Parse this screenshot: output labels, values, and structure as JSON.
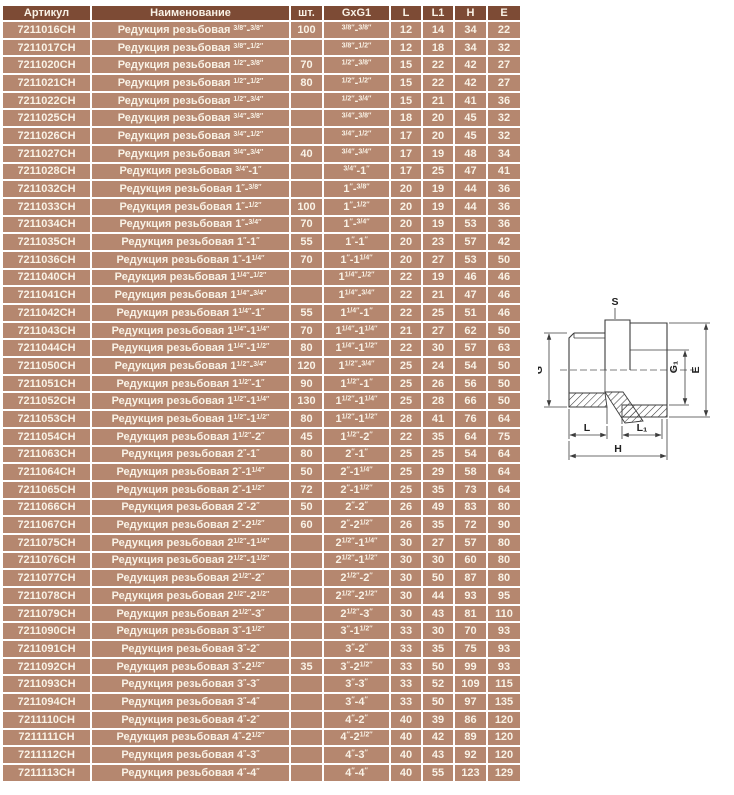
{
  "page": {
    "background": "#ffffff"
  },
  "table": {
    "columns": [
      "Артикул",
      "Наименование",
      "шт.",
      "GxG1",
      "L",
      "L1",
      "H",
      "E"
    ],
    "name_prefix": "Редукция резьбовая",
    "inch_mark": "″",
    "size_separator": "-",
    "colors": {
      "header_bg": "#7d4b35",
      "row_bg": "#b5876f",
      "text": "#f9f2e6",
      "separator": "#ffffff"
    },
    "rows": [
      {
        "art": "7211016CH",
        "qty": "100",
        "g": "3/8",
        "g1": "3/8",
        "dims": [
          "12",
          "14",
          "34",
          "22"
        ]
      },
      {
        "art": "7211017CH",
        "qty": "",
        "g": "3/8",
        "g1": "1/2",
        "dims": [
          "12",
          "18",
          "34",
          "32"
        ]
      },
      {
        "art": "7211020CH",
        "qty": "70",
        "g": "1/2",
        "g1": "3/8",
        "dims": [
          "15",
          "22",
          "42",
          "27"
        ]
      },
      {
        "art": "7211021CH",
        "qty": "80",
        "g": "1/2",
        "g1": "1/2",
        "dims": [
          "15",
          "22",
          "42",
          "27"
        ]
      },
      {
        "art": "7211022CH",
        "qty": "",
        "g": "1/2",
        "g1": "3/4",
        "dims": [
          "15",
          "21",
          "41",
          "36"
        ]
      },
      {
        "art": "7211025CH",
        "qty": "",
        "g": "3/4",
        "g1": "3/8",
        "dims": [
          "18",
          "20",
          "45",
          "32"
        ]
      },
      {
        "art": "7211026CH",
        "qty": "",
        "g": "3/4",
        "g1": "1/2",
        "dims": [
          "17",
          "20",
          "45",
          "32"
        ]
      },
      {
        "art": "7211027CH",
        "qty": "40",
        "g": "3/4",
        "g1": "3/4",
        "dims": [
          "17",
          "19",
          "48",
          "34"
        ]
      },
      {
        "art": "7211028CH",
        "qty": "",
        "g": "3/4",
        "g1": "1",
        "dims": [
          "17",
          "25",
          "47",
          "41"
        ]
      },
      {
        "art": "7211032CH",
        "qty": "",
        "g": "1",
        "g1": "3/8",
        "dims": [
          "20",
          "19",
          "44",
          "36"
        ]
      },
      {
        "art": "7211033CH",
        "qty": "100",
        "g": "1",
        "g1": "1/2",
        "dims": [
          "20",
          "19",
          "44",
          "36"
        ]
      },
      {
        "art": "7211034CH",
        "qty": "70",
        "g": "1",
        "g1": "3/4",
        "dims": [
          "20",
          "19",
          "53",
          "36"
        ]
      },
      {
        "art": "7211035CH",
        "qty": "55",
        "g": "1",
        "g1": "1",
        "dims": [
          "20",
          "23",
          "57",
          "42"
        ]
      },
      {
        "art": "7211036CH",
        "qty": "70",
        "g": "1",
        "g1": "1 1/4",
        "dims": [
          "20",
          "27",
          "53",
          "50"
        ]
      },
      {
        "art": "7211040CH",
        "qty": "",
        "g": "1 1/4",
        "g1": "1/2",
        "dims": [
          "22",
          "19",
          "46",
          "46"
        ]
      },
      {
        "art": "7211041CH",
        "qty": "",
        "g": "1 1/4",
        "g1": "3/4",
        "dims": [
          "22",
          "21",
          "47",
          "46"
        ]
      },
      {
        "art": "7211042CH",
        "qty": "55",
        "g": "1 1/4",
        "g1": "1",
        "dims": [
          "22",
          "25",
          "51",
          "46"
        ]
      },
      {
        "art": "7211043CH",
        "qty": "70",
        "g": "1 1/4",
        "g1": "1 1/4",
        "dims": [
          "21",
          "27",
          "62",
          "50"
        ]
      },
      {
        "art": "7211044CH",
        "qty": "80",
        "g": "1 1/4",
        "g1": "1 1/2",
        "dims": [
          "22",
          "30",
          "57",
          "63"
        ]
      },
      {
        "art": "7211050CH",
        "qty": "120",
        "g": "1 1/2",
        "g1": "3/4",
        "dims": [
          "25",
          "24",
          "54",
          "50"
        ]
      },
      {
        "art": "7211051CH",
        "qty": "90",
        "g": "1 1/2",
        "g1": "1",
        "dims": [
          "25",
          "26",
          "56",
          "50"
        ]
      },
      {
        "art": "7211052CH",
        "qty": "130",
        "g": "1 1/2",
        "g1": "1 1/4",
        "dims": [
          "25",
          "28",
          "66",
          "50"
        ]
      },
      {
        "art": "7211053CH",
        "qty": "80",
        "g": "1 1/2",
        "g1": "1 1/2",
        "dims": [
          "28",
          "41",
          "76",
          "64"
        ]
      },
      {
        "art": "7211054CH",
        "qty": "45",
        "g": "1 1/2",
        "g1": "2",
        "dims": [
          "22",
          "35",
          "64",
          "75"
        ]
      },
      {
        "art": "7211063CH",
        "qty": "80",
        "g": "2",
        "g1": "1",
        "dims": [
          "25",
          "25",
          "54",
          "64"
        ]
      },
      {
        "art": "7211064CH",
        "qty": "50",
        "g": "2",
        "g1": "1 1/4",
        "dims": [
          "25",
          "29",
          "58",
          "64"
        ]
      },
      {
        "art": "7211065CH",
        "qty": "72",
        "g": "2",
        "g1": "1 1/2",
        "dims": [
          "25",
          "35",
          "73",
          "64"
        ]
      },
      {
        "art": "7211066CH",
        "qty": "50",
        "g": "2",
        "g1": "2",
        "dims": [
          "26",
          "49",
          "83",
          "80"
        ]
      },
      {
        "art": "7211067CH",
        "qty": "60",
        "g": "2",
        "g1": "2 1/2",
        "dims": [
          "26",
          "35",
          "72",
          "90"
        ]
      },
      {
        "art": "7211075CH",
        "qty": "",
        "g": "2 1/2",
        "g1": "1 1/4",
        "dims": [
          "30",
          "27",
          "57",
          "80"
        ]
      },
      {
        "art": "7211076CH",
        "qty": "",
        "g": "2 1/2",
        "g1": "1 1/2",
        "dims": [
          "30",
          "30",
          "60",
          "80"
        ]
      },
      {
        "art": "7211077CH",
        "qty": "",
        "g": "2 1/2",
        "g1": "2",
        "dims": [
          "30",
          "50",
          "87",
          "80"
        ]
      },
      {
        "art": "7211078CH",
        "qty": "",
        "g": "2 1/2",
        "g1": "2 1/2",
        "dims": [
          "30",
          "44",
          "93",
          "95"
        ]
      },
      {
        "art": "7211079CH",
        "qty": "",
        "g": "2 1/2",
        "g1": "3",
        "dims": [
          "30",
          "43",
          "81",
          "110"
        ]
      },
      {
        "art": "7211090CH",
        "qty": "",
        "g": "3",
        "g1": "1 1/2",
        "dims": [
          "33",
          "30",
          "70",
          "93"
        ]
      },
      {
        "art": "7211091CH",
        "qty": "",
        "g": "3",
        "g1": "2",
        "dims": [
          "33",
          "35",
          "75",
          "93"
        ]
      },
      {
        "art": "7211092CH",
        "qty": "35",
        "g": "3",
        "g1": "2 1/2",
        "dims": [
          "33",
          "50",
          "99",
          "93"
        ]
      },
      {
        "art": "7211093CH",
        "qty": "",
        "g": "3",
        "g1": "3",
        "dims": [
          "33",
          "52",
          "109",
          "115"
        ]
      },
      {
        "art": "7211094CH",
        "qty": "",
        "g": "3",
        "g1": "4",
        "dims": [
          "33",
          "50",
          "97",
          "135"
        ]
      },
      {
        "art": "7211110CH",
        "qty": "",
        "g": "4",
        "g1": "2",
        "dims": [
          "40",
          "39",
          "86",
          "120"
        ]
      },
      {
        "art": "7211111CH",
        "qty": "",
        "g": "4",
        "g1": "2 1/2",
        "dims": [
          "40",
          "42",
          "89",
          "120"
        ]
      },
      {
        "art": "7211112CH",
        "qty": "",
        "g": "4",
        "g1": "3",
        "dims": [
          "40",
          "43",
          "92",
          "120"
        ]
      },
      {
        "art": "7211113CH",
        "qty": "",
        "g": "4",
        "g1": "4",
        "dims": [
          "40",
          "55",
          "123",
          "129"
        ]
      }
    ]
  },
  "drawing": {
    "labels": {
      "s": "S",
      "g": "G",
      "g1": "G₁",
      "e": "E",
      "l": "L",
      "l1": "L₁",
      "h": "H"
    }
  }
}
